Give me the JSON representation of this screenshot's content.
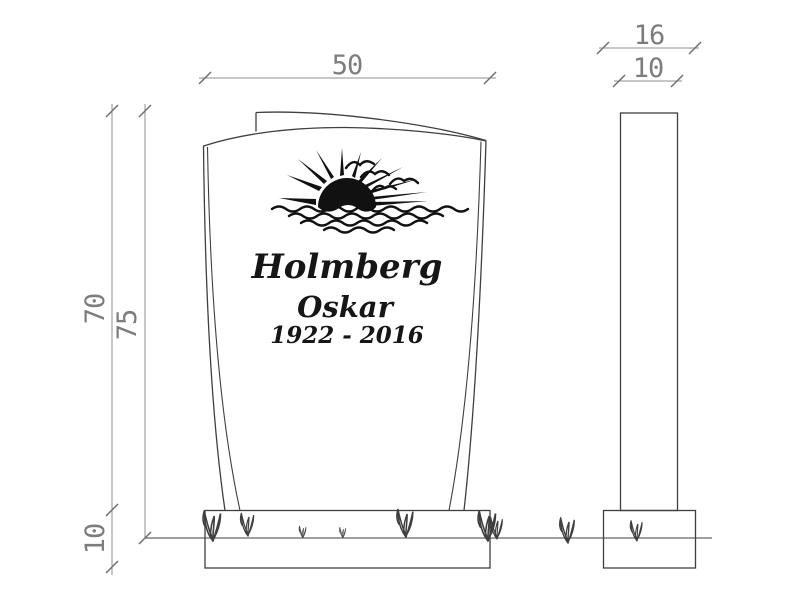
{
  "memorial": {
    "family_name": "Holmberg",
    "given_name": "Oskar",
    "dates": "1922 - 2016"
  },
  "dimensions": {
    "front_width": "50",
    "stone_height": "70",
    "total_height": "75",
    "base_height": "10",
    "base_depth": "16",
    "stone_depth": "10"
  },
  "colors": {
    "background": "#ffffff",
    "object_line": "#3f3f3f",
    "dimension_line": "#8f8f8f",
    "dimension_text": "#7d7d7d",
    "artwork": "#111111"
  },
  "icons": {
    "sun": "rising-sun-with-rays",
    "birds": "flying-birds",
    "water": "wavy-water-lines",
    "grass": "grass-tuft"
  }
}
